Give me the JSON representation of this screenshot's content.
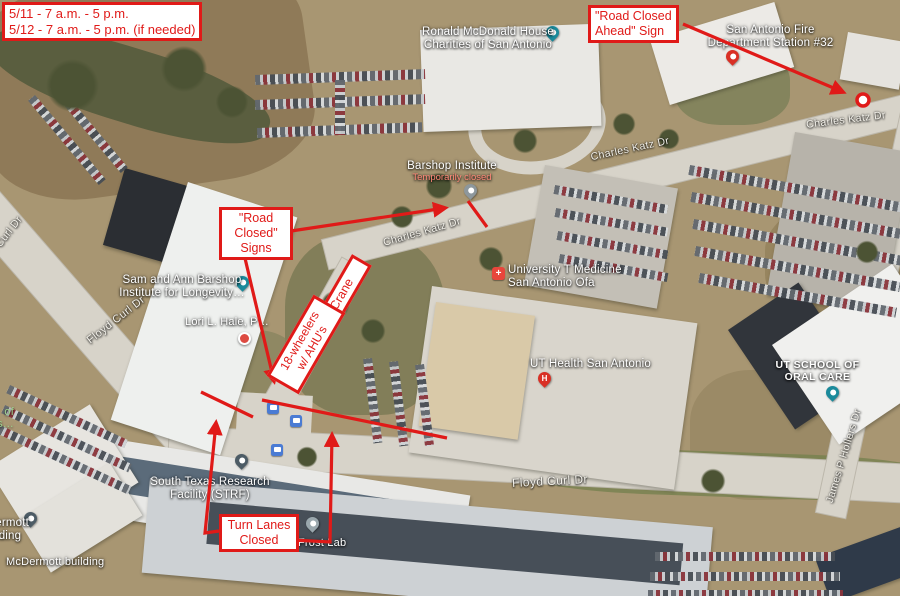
{
  "schedule": {
    "line1": "5/11 - 7 a.m. - 5 p.m.",
    "line2": "5/12 - 7 a.m. - 5 p.m. (if needed)"
  },
  "callouts": {
    "road_closed_ahead": {
      "line1": "\"Road Closed",
      "line2": "Ahead\" Sign"
    },
    "road_closed_signs": {
      "line1": "\"Road",
      "line2": "Closed\"",
      "line3": "Signs"
    },
    "crane": "Crane",
    "wheelers": {
      "line1": "18-wheelers",
      "line2": "w/ AHU's"
    },
    "turn_lanes": {
      "line1": "Turn Lanes",
      "line2": "Closed"
    }
  },
  "places": {
    "ronald_mcdonald": {
      "line1": "Ronald McDonald House",
      "line2": "Charities of San Antonio"
    },
    "fire_station": {
      "line1": "San Antonio Fire",
      "line2": "Department Station #32"
    },
    "barshop_institute": {
      "name": "Barshop Institute",
      "status": "Temporarily closed"
    },
    "sam_ann_barshop": {
      "line1": "Sam and Ann Barshop",
      "line2": "Institute for Longevity…"
    },
    "lori_hale": {
      "name": "Lori L. Hale, P…"
    },
    "university_t_medicine": {
      "line1": "University T Medicine",
      "line2": "San Antonio Ofa"
    },
    "ut_health": {
      "name": "UT Health San Antonio"
    },
    "ut_school_oral_care": {
      "line1": "UT SCHOOL OF",
      "line2": "ORAL CARE"
    },
    "strf": {
      "line1": "South Texas Research",
      "line2": "Facility (STRF)"
    },
    "frost_lab": {
      "name": "Frost Lab"
    },
    "mcdermott_roof": {
      "name": "McDermott building"
    },
    "mcdermott_partial": {
      "line1": "McDermott",
      "line2": "Building"
    },
    "campus_partial": {
      "line1": "of",
      "line2": "Texas…"
    }
  },
  "streets": {
    "charles_katz_upper": "Charles Katz Dr",
    "charles_katz_mid": "Charles Katz Dr",
    "charles_katz_east": "Charles Katz Dr",
    "floyd_curl_nw": "Floyd Curl Dr",
    "floyd_curl_west": "Floyd Curl Dr",
    "floyd_curl_south": "Floyd Curl Dr",
    "james_hollers": "James P Hollers Dr"
  },
  "icons": {
    "hospital_h": "H",
    "medical_plus": "+"
  },
  "colors": {
    "annotation_red": "#e01a18",
    "map_pin_teal": "#1b8a9b"
  }
}
